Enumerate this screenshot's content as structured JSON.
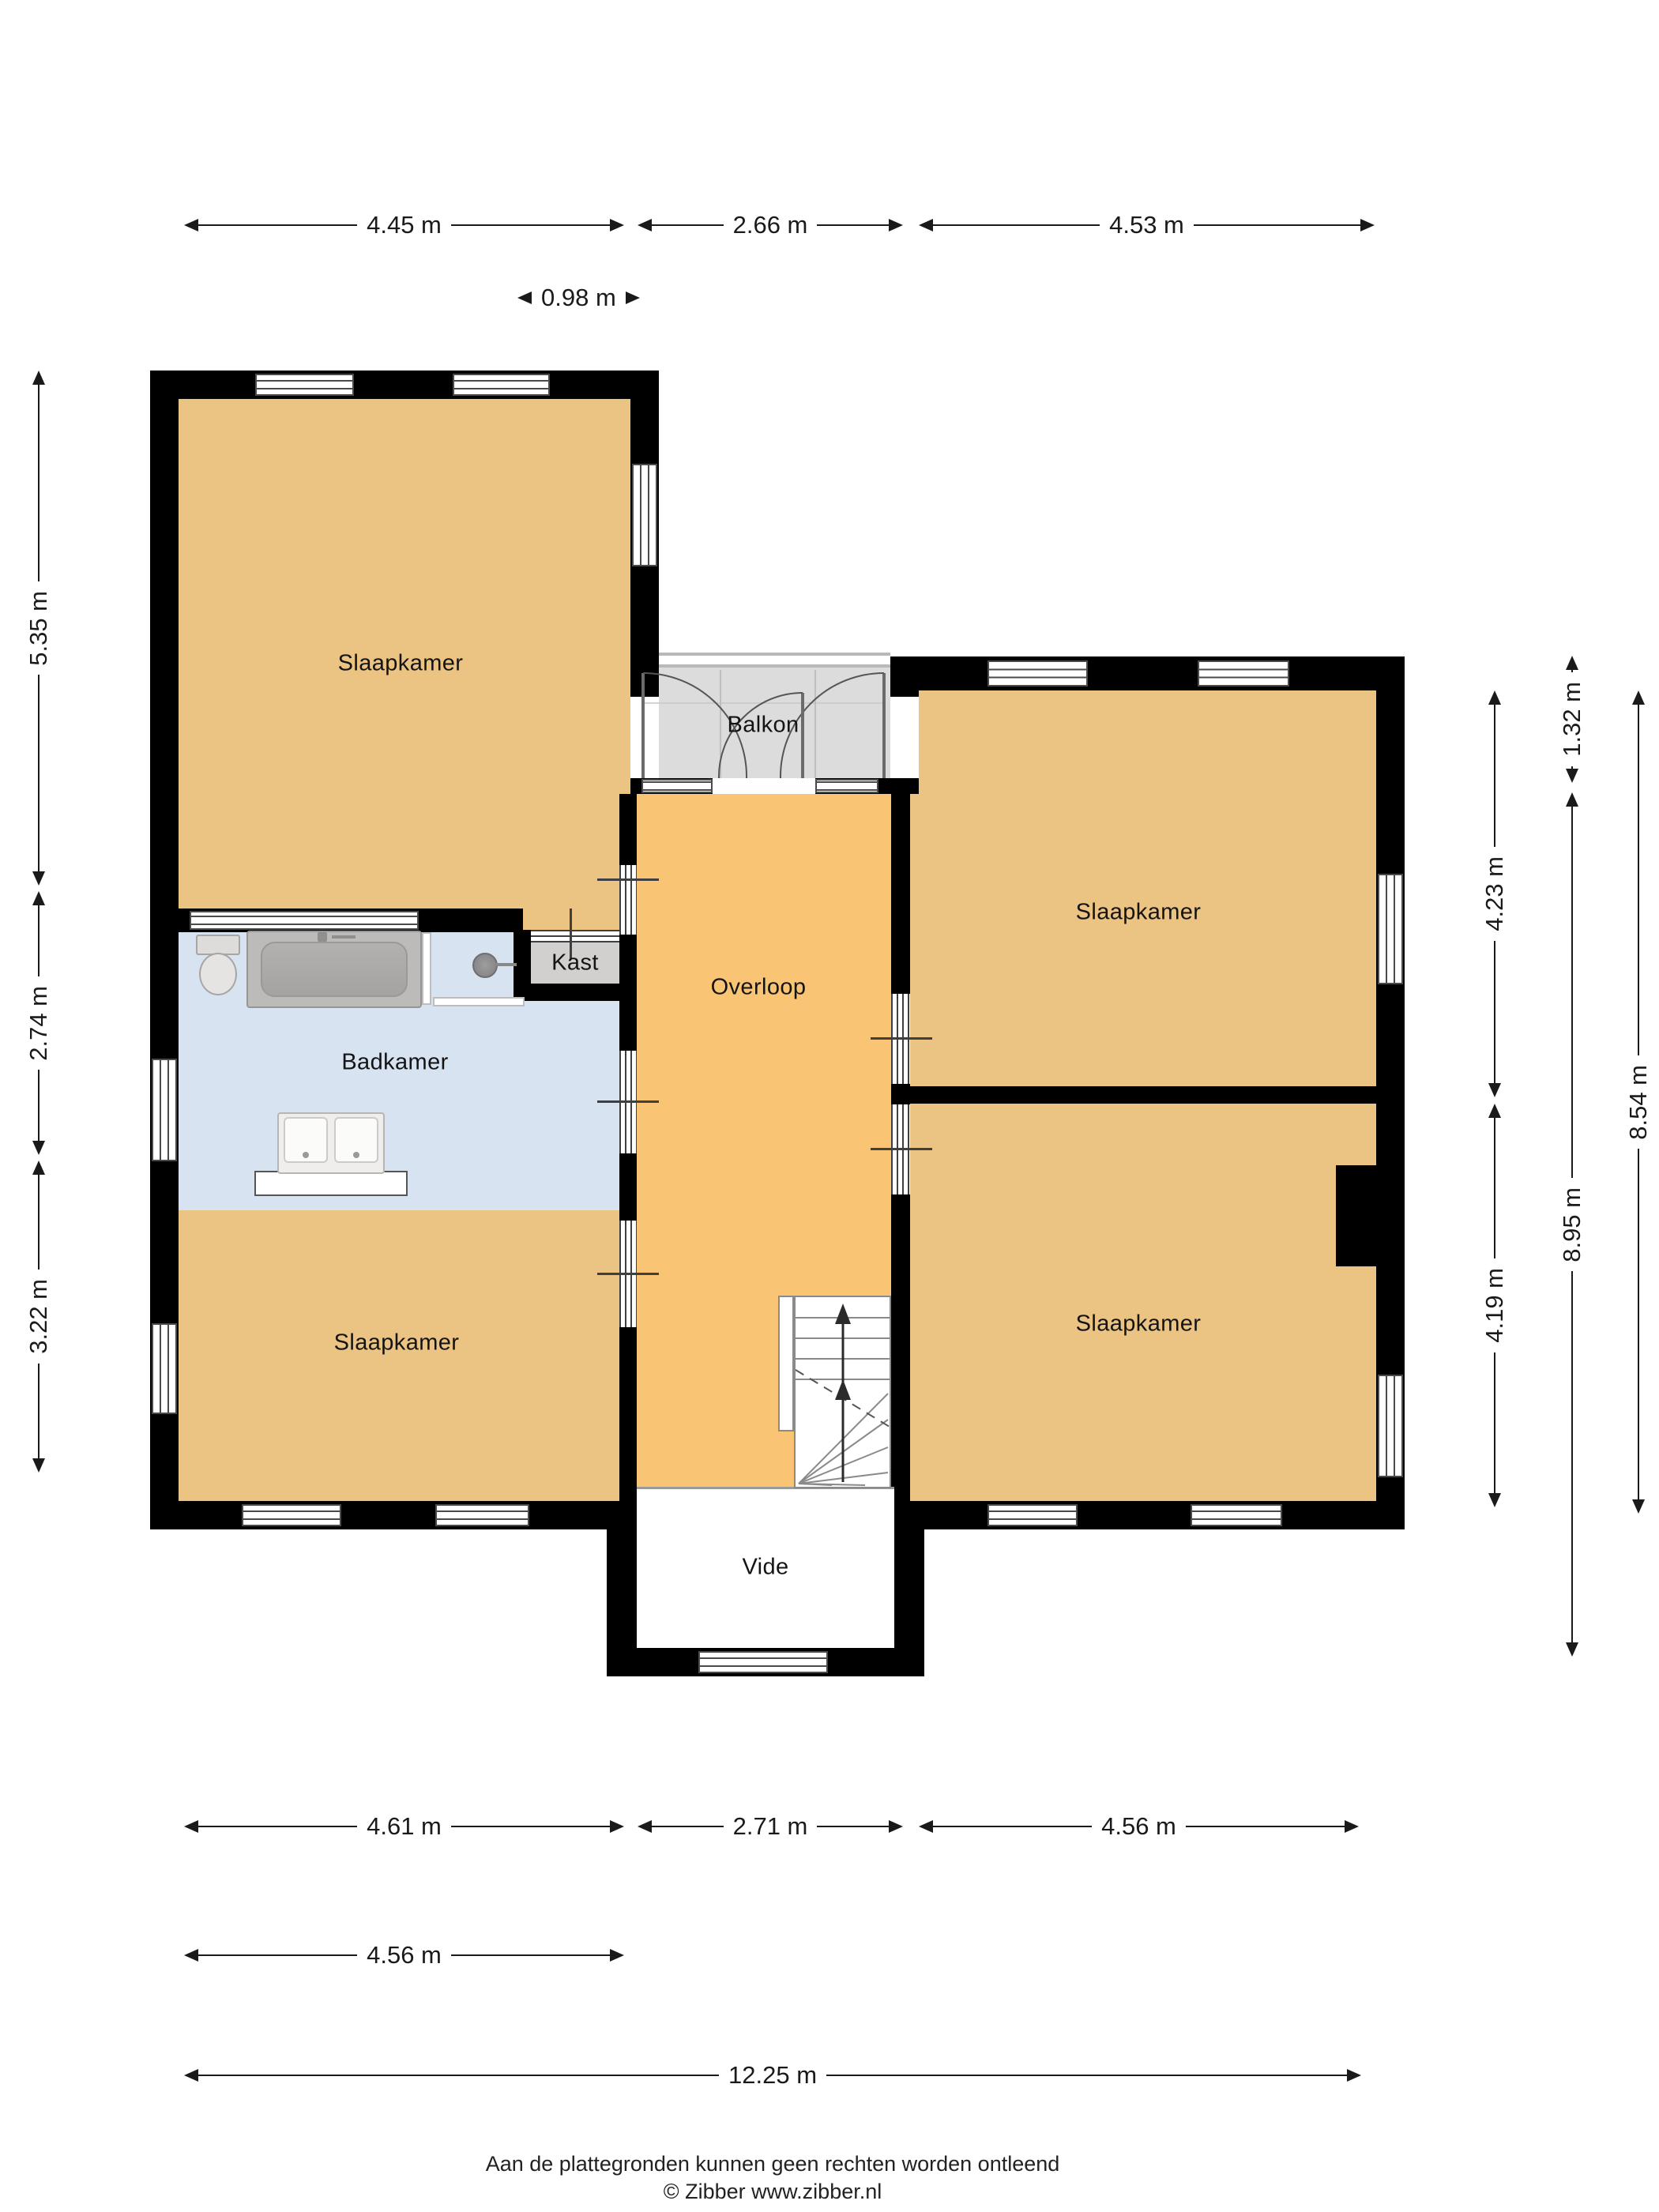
{
  "title": "Plattegrond eerste verdieping",
  "colors": {
    "wall": "#000000",
    "bedroom_fill": "#EBC383",
    "landing_fill": "#F9C473",
    "bathroom_fill": "#D7E3F0",
    "balcony_fill": "#DCDCDC",
    "closet_fill": "#D2D0CE",
    "void_fill": "#FFFFFF",
    "dimension_text": "#1A1A1A"
  },
  "rooms": [
    {
      "id": "slaapkamer-topleft",
      "label": "Slaapkamer"
    },
    {
      "id": "balkon",
      "label": "Balkon"
    },
    {
      "id": "slaapkamer-topright",
      "label": "Slaapkamer"
    },
    {
      "id": "kast",
      "label": "Kast"
    },
    {
      "id": "badkamer",
      "label": "Badkamer"
    },
    {
      "id": "overloop",
      "label": "Overloop"
    },
    {
      "id": "slaapkamer-bottomleft",
      "label": "Slaapkamer"
    },
    {
      "id": "slaapkamer-bottomright",
      "label": "Slaapkamer"
    },
    {
      "id": "vide",
      "label": "Vide"
    }
  ],
  "dimensions": {
    "top": [
      {
        "label": "4.45 m"
      },
      {
        "label": "2.66 m"
      },
      {
        "label": "4.53 m"
      },
      {
        "label": "0.98 m"
      }
    ],
    "left": [
      {
        "label": "5.35 m"
      },
      {
        "label": "2.74 m"
      },
      {
        "label": "3.22 m"
      }
    ],
    "right_inner": [
      {
        "label": "4.23 m"
      },
      {
        "label": "4.19 m"
      }
    ],
    "right_middle": [
      {
        "label": "1.32 m"
      },
      {
        "label": "8.95 m"
      }
    ],
    "right_outer": [
      {
        "label": "8.54 m"
      }
    ],
    "bottom_row1": [
      {
        "label": "4.61 m"
      },
      {
        "label": "2.71 m"
      },
      {
        "label": "4.56 m"
      }
    ],
    "bottom_row2": [
      {
        "label": "4.56 m"
      }
    ],
    "bottom_row3": [
      {
        "label": "12.25 m"
      }
    ]
  },
  "footer": {
    "line1": "Aan de plattegronden kunnen geen rechten worden ontleend",
    "line2": "© Zibber www.zibber.nl"
  }
}
